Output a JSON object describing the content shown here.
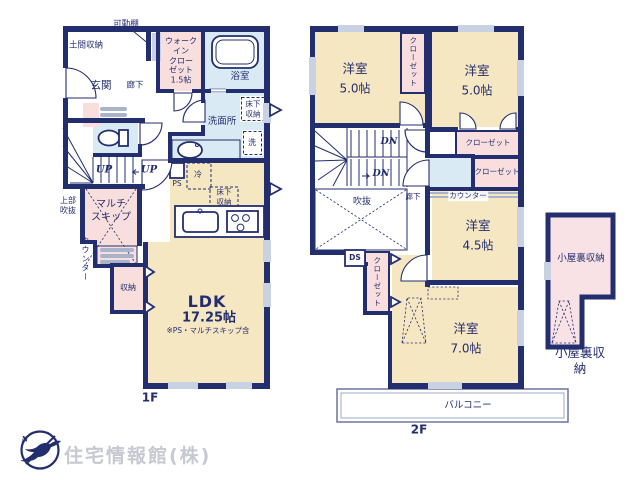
{
  "f1": {
    "floor_label": "1F",
    "movable_shelf": "可動棚",
    "doma_storage": "土間収納",
    "entrance": "玄関",
    "hallway": "廊下",
    "walk_in_closet": "ウォーク\nイン\nクロー\nゼット\n1.5帖",
    "bathroom": "浴室",
    "underfloor_storage_bath": "床下\n収納",
    "washroom": "洗面所",
    "washer": "洗",
    "pipe_space": "PS",
    "fridge": "冷",
    "underfloor_storage_kitchen": "床下\n収納",
    "stairs_up_1": "UP",
    "stairs_up_2": "UP",
    "multi_skip": "マルチ\nスキップ",
    "upper_void": "上部\n吹抜",
    "counter": "カウンター",
    "storage": "収納",
    "ldk_name": "LDK",
    "ldk_size": "17.25帖",
    "ldk_note": "※PS・マルチスキップ含"
  },
  "f2": {
    "floor_label": "2F",
    "bedroom_nw": {
      "name": "洋室",
      "size": "5.0帖"
    },
    "closet_nw": "クローゼット",
    "bedroom_ne": {
      "name": "洋室",
      "size": "5.0帖"
    },
    "closet_ne": "クローゼット",
    "closet_e": "クローゼット",
    "stairs_dn_1": "DN",
    "stairs_dn_2": "DN",
    "void": "吹抜",
    "hallway": "廊下",
    "counter": "カウンター",
    "bedroom_e": {
      "name": "洋室",
      "size": "4.5帖"
    },
    "duct_space": "DS",
    "closet_s": "クローゼット",
    "bedroom_s": {
      "name": "洋室",
      "size": "7.0帖"
    },
    "balcony": "バルコニー"
  },
  "attic": {
    "label_inside": "小屋裏収納",
    "label_caption": "小屋裏収納"
  },
  "logo": {
    "company": "住宅情報館(株)",
    "compass_n": "N"
  },
  "colors": {
    "wall": "#232e6e",
    "room": "#f6e7c3",
    "closet": "#f9dede",
    "wet": "#daeaf4",
    "attic": "#f9e2e6",
    "window": "#c9d2e2"
  }
}
